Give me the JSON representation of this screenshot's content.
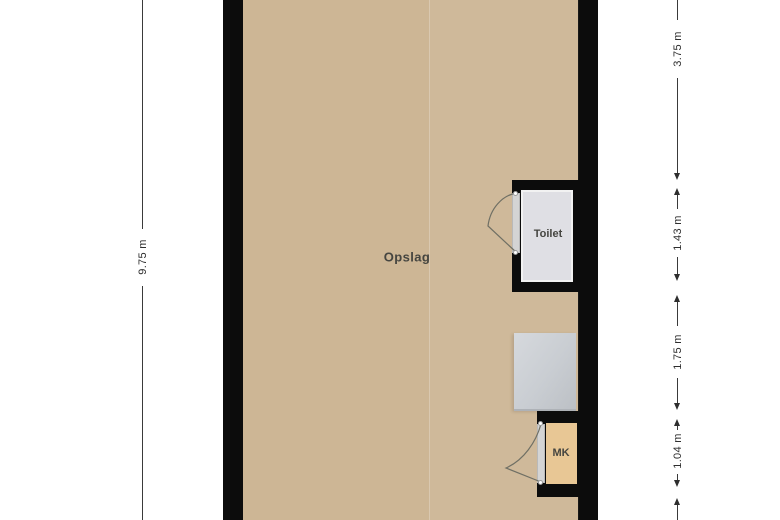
{
  "plan": {
    "rooms": [
      {
        "id": "opslag",
        "label": "Opslag",
        "floor_color": "#cdb695"
      },
      {
        "id": "toilet",
        "label": "Toilet",
        "floor_color": "#dfdfe4"
      },
      {
        "id": "mk",
        "label": "MK",
        "floor_color": "#e8c795"
      }
    ],
    "wall_color": "#0c0c0c",
    "fixture_color": "#c9cdd2",
    "background_color": "#ffffff"
  },
  "dimensions": {
    "left": [
      {
        "label": "9.75 m"
      }
    ],
    "right": [
      {
        "label": "3.75 m"
      },
      {
        "label": "1.43 m"
      },
      {
        "label": "1.75 m"
      },
      {
        "label": "1.04 m"
      }
    ]
  }
}
